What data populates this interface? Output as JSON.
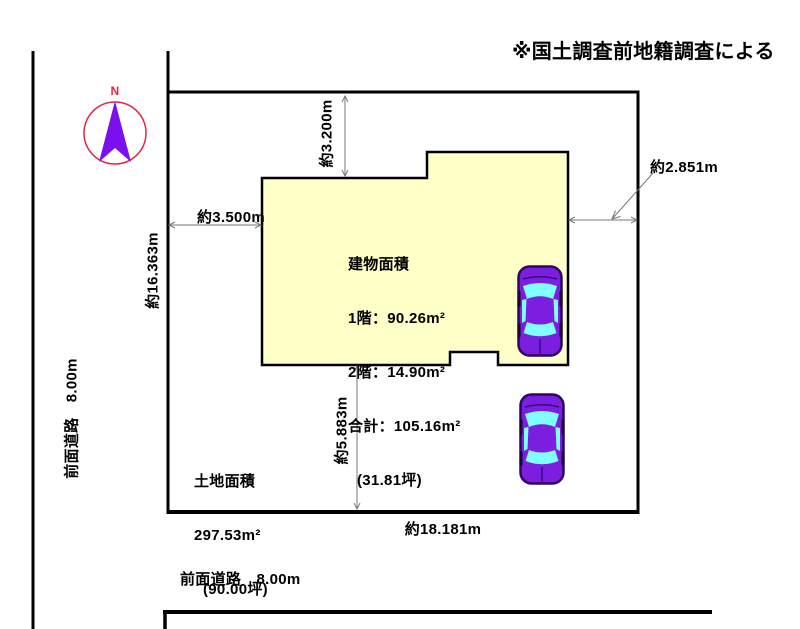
{
  "note": "※国土調査前地籍調査による",
  "compass": {
    "label": "N"
  },
  "dimensions": {
    "top_setback": "約3.200m",
    "left_setback": "約3.500m",
    "left_side": "約16.363m",
    "right_setback": "約2.851m",
    "bottom_setback": "約5.883m",
    "frontage": "約18.181m"
  },
  "building_info": {
    "title": "建物面積",
    "floor1": "1階：90.26m²",
    "floor2": "2階：14.90m²",
    "total": "合計：105.16m²",
    "tsubo": "(31.81坪)"
  },
  "land_info": {
    "title": "土地面積",
    "area": "297.53m²",
    "tsubo": "(90.00坪)"
  },
  "roads": {
    "left": "前面道路　8.00m",
    "bottom": "前面道路　8.00m"
  },
  "colors": {
    "building_fill": "#FFFFC8",
    "car_body": "#7B1EE0",
    "car_window": "#80FFFF",
    "compass_ring": "#E02845",
    "needle": "#7B10EE",
    "dim_line": "#777777"
  }
}
